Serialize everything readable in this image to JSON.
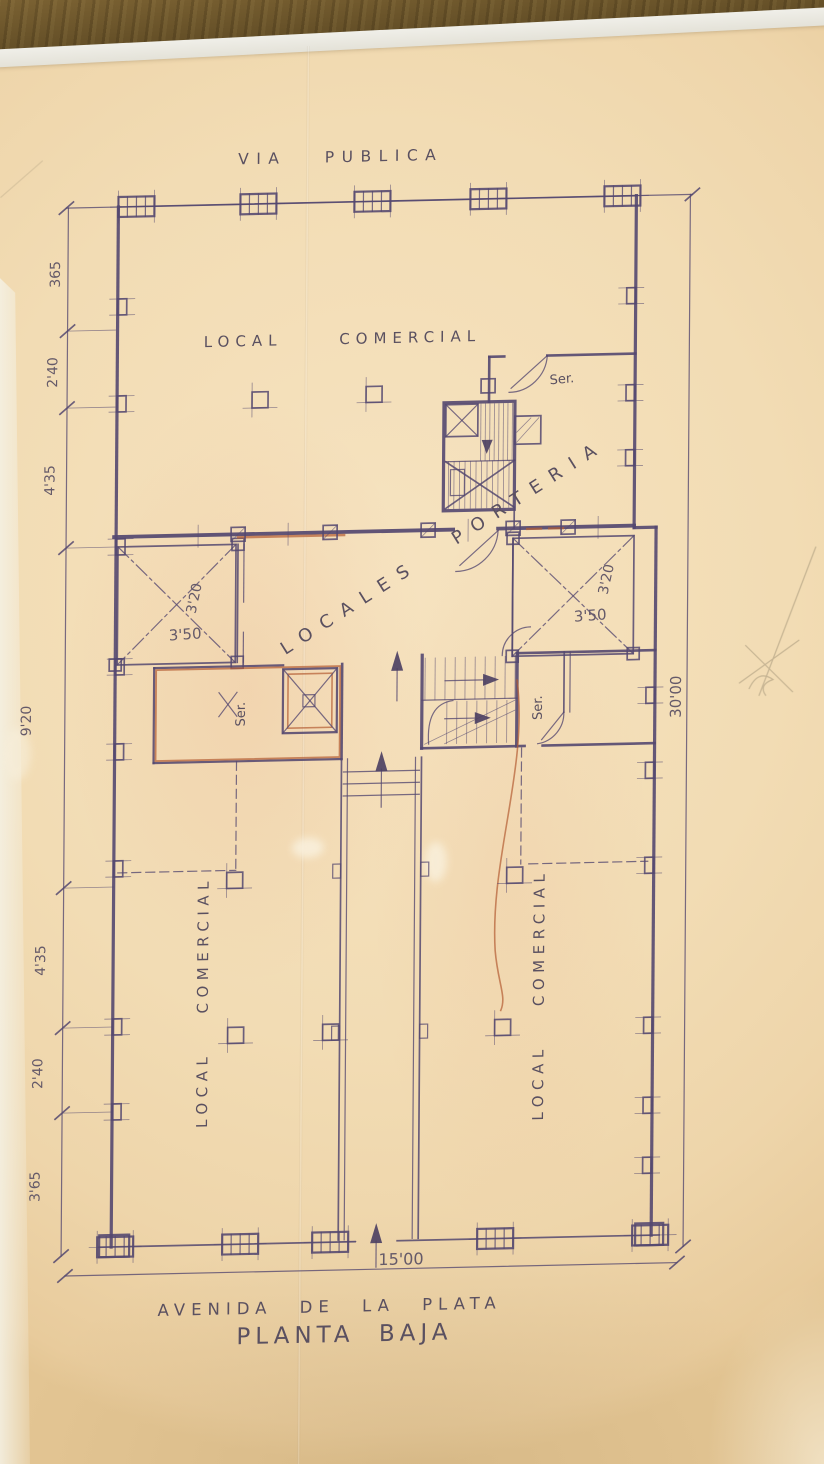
{
  "photo": {
    "surface": "wood-table",
    "wood_color": "#6e5628",
    "paper_color": "#f2dcb4"
  },
  "plan": {
    "street_top": "VIA PUBLICA",
    "street_bottom": "AVENIDA DE LA PLATA",
    "title": "PLANTA BAJA",
    "labels": {
      "shop_top": "LOCAL COMERCIAL",
      "shop_left": "LOCAL COMERCIAL",
      "shop_right": "LOCAL COMERCIAL",
      "porter_area": "LOCALES PORTERIA",
      "service_top": "Ser.",
      "service_left": "Ser.",
      "service_right": "Ser."
    },
    "dimensions": {
      "left_chain": [
        "365",
        "2'40",
        "4'35",
        "9'20",
        "4'35",
        "2'40",
        "3'65"
      ],
      "total_width": "15'00",
      "total_depth": "30'00",
      "left_room": {
        "width": "3'50",
        "depth": "3'20"
      },
      "right_room": {
        "width": "3'50",
        "depth": "3'20"
      }
    },
    "ink_color": "#544870",
    "accent_color": "#b45c33"
  }
}
